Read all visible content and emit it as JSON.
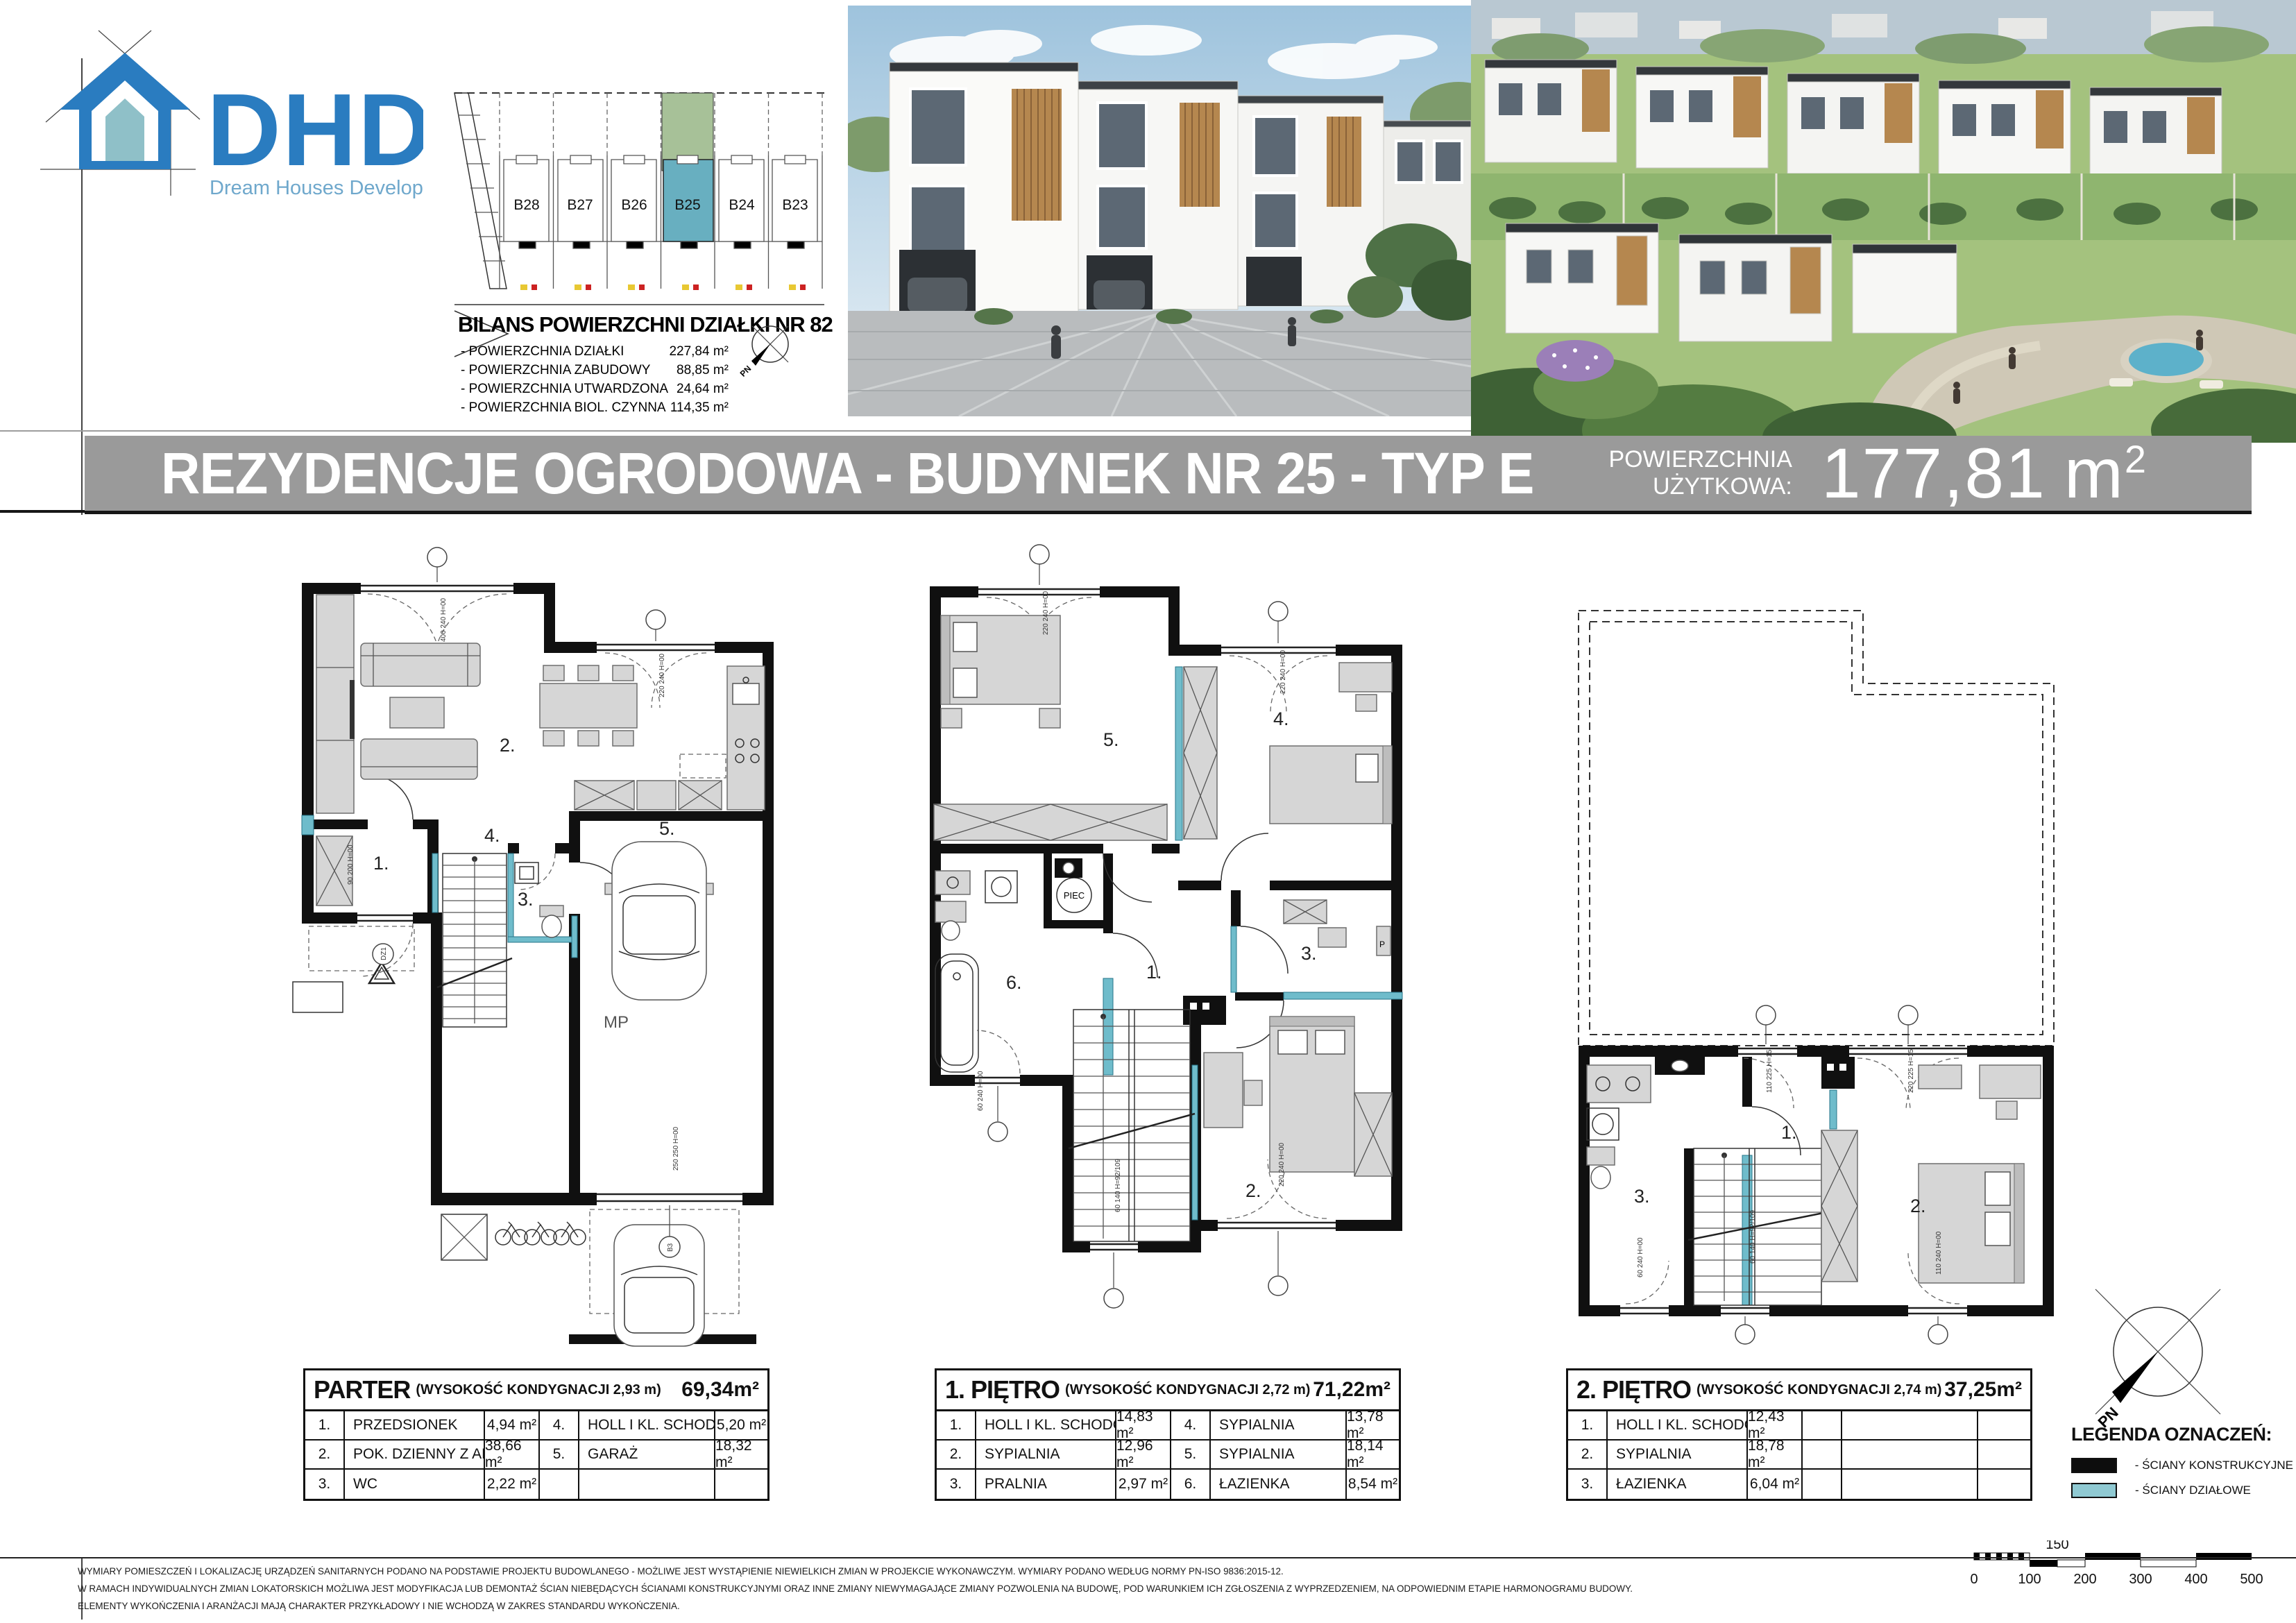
{
  "logo": {
    "abbr": "DHD",
    "tagline": "Dream Houses Development"
  },
  "site_plan": {
    "plots": [
      "B28",
      "B27",
      "B26",
      "B25",
      "B24",
      "B23"
    ],
    "highlighted_plot": "B25",
    "bilans_title": "BILANS POWIERZCHNI DZIAŁKI NR 823",
    "bilans_items": [
      {
        "label": "- POWIERZCHNIA DZIAŁKI",
        "value": "227,84 m²"
      },
      {
        "label": "- POWIERZCHNIA ZABUDOWY",
        "value": "88,85 m²"
      },
      {
        "label": "- POWIERZCHNIA UTWARDZONA",
        "value": "24,64 m²"
      },
      {
        "label": "- POWIERZCHNIA BIOL. CZYNNA",
        "value": "114,35 m²"
      }
    ],
    "compass_label": "PN"
  },
  "title_bar": {
    "title": "REZYDENCJE OGRODOWA - BUDYNEK NR 25 - TYP E",
    "area_label_line1": "POWIERZCHNIA",
    "area_label_line2": "UŻYTKOWA:",
    "area_value": "177,81",
    "area_unit": "m",
    "area_exponent": "2"
  },
  "plans": {
    "parter": {
      "rooms": [
        "1.",
        "2.",
        "3.",
        "4.",
        "5."
      ],
      "parking_label": "MP",
      "axis_labels": [
        "DZ1",
        "B3"
      ],
      "window_notes": [
        "400 240 H=00",
        "220 240 H=00",
        "90 200 H=00",
        "250 250 H=00"
      ]
    },
    "pietro1": {
      "rooms": [
        "1.",
        "2.",
        "3.",
        "4.",
        "5.",
        "6."
      ],
      "boiler_label": "PIEC",
      "p_label": "P",
      "window_notes": [
        "220 240 H=00",
        "220 240 H=00",
        "60 240 H=00",
        "60 140 H=92/109",
        "220 240 H=00"
      ]
    },
    "pietro2": {
      "rooms": [
        "1.",
        "2.",
        "3."
      ],
      "window_notes": [
        "110 225 H=15",
        "220 225 H=15",
        "60 240 H=00",
        "60 140 H=92/109",
        "110 240 H=00"
      ]
    }
  },
  "floors": [
    {
      "name": "PARTER",
      "height": "(WYSOKOŚĆ KONDYGNACJI 2,93 m)",
      "total": "69,34m²",
      "rows": [
        [
          {
            "no": "1.",
            "room": "PRZEDSIONEK",
            "area": "4,94 m²"
          },
          {
            "no": "4.",
            "room": "HOLL I KL. SCHODOWA",
            "area": "5,20 m²"
          }
        ],
        [
          {
            "no": "2.",
            "room": "POK. DZIENNY Z AN. KUCH.",
            "area": "38,66 m²"
          },
          {
            "no": "5.",
            "room": "GARAŻ",
            "area": "18,32 m²"
          }
        ],
        [
          {
            "no": "3.",
            "room": "WC",
            "area": "2,22 m²"
          },
          {
            "no": "",
            "room": "",
            "area": ""
          }
        ]
      ]
    },
    {
      "name": "1. PIĘTRO",
      "height": "(WYSOKOŚĆ KONDYGNACJI 2,72 m)",
      "total": "71,22m²",
      "rows": [
        [
          {
            "no": "1.",
            "room": "HOLL I KL. SCHODOWA",
            "area": "14,83 m²"
          },
          {
            "no": "4.",
            "room": "SYPIALNIA",
            "area": "13,78 m²"
          }
        ],
        [
          {
            "no": "2.",
            "room": "SYPIALNIA",
            "area": "12,96 m²"
          },
          {
            "no": "5.",
            "room": "SYPIALNIA",
            "area": "18,14 m²"
          }
        ],
        [
          {
            "no": "3.",
            "room": "PRALNIA",
            "area": "2,97 m²"
          },
          {
            "no": "6.",
            "room": "ŁAZIENKA",
            "area": "8,54 m²"
          }
        ]
      ]
    },
    {
      "name": "2. PIĘTRO",
      "height": "(WYSOKOŚĆ KONDYGNACJI 2,74 m)",
      "total": "37,25m²",
      "rows": [
        [
          {
            "no": "1.",
            "room": "HOLL I KL. SCHODOWA",
            "area": "12,43 m²"
          },
          {
            "no": "",
            "room": "",
            "area": ""
          }
        ],
        [
          {
            "no": "2.",
            "room": "SYPIALNIA",
            "area": "18,78 m²"
          },
          {
            "no": "",
            "room": "",
            "area": ""
          }
        ],
        [
          {
            "no": "3.",
            "room": "ŁAZIENKA",
            "area": "6,04 m²"
          },
          {
            "no": "",
            "room": "",
            "area": ""
          }
        ]
      ]
    }
  ],
  "legend": {
    "title": "LEGENDA OZNACZEŃ:",
    "items": [
      {
        "label": "- ŚCIANY KONSTRUKCYJNE"
      },
      {
        "label": "- ŚCIANY DZIAŁOWE"
      }
    ]
  },
  "compass": {
    "label": "PN"
  },
  "scale_bar": {
    "ticks": [
      "0",
      "100",
      "200",
      "300",
      "400",
      "500"
    ],
    "mid_label": "150"
  },
  "disclaimer": [
    "WYMIARY POMIESZCZEŃ I LOKALIZACJĘ URZĄDZEŃ SANITARNYCH PODANO NA PODSTAWIE PROJEKTU BUDOWLANEGO - MOŻLIWE JEST WYSTĄPIENIE NIEWIELKICH ZMIAN W PROJEKCIE WYKONAWCZYM. WYMIARY PODANO WEDŁUG NORMY PN-ISO 9836:2015-12.",
    "W RAMACH INDYWIDUALNYCH ZMIAN LOKATORSKICH MOŻLIWA JEST MODYFIKACJA LUB DEMONTAŻ ŚCIAN NIEBĘDĄCYCH ŚCIANAMI KONSTRUKCYJNYMI ORAZ INNE ZMIANY NIEWYMAGAJĄCE ZMIANY POZWOLENIA NA BUDOWĘ, POD WARUNKIEM ICH ZGŁOSZENIA Z WYPRZEDZENIEM, NA ODPOWIEDNIM ETAPIE HARMONOGRAMU BUDOWY.",
    "ELEMENTY WYKOŃCZENIA I ARANŻACJI MAJĄ CHARAKTER PRZYKŁADOWY I NIE WCHODZĄ W ZAKRES STANDARDU WYKOŃCZENIA."
  ],
  "colors": {
    "logo_blue": "#2a7cc0",
    "logo_teal": "#8fc0c8",
    "bar_gray": "#9a9a9a",
    "partition_teal": "#6fbccb",
    "legend_teal": "#8fc9d2",
    "plot_green": "#a7c198",
    "plot_blue": "#68afc0",
    "wood_accent": "#b5874f"
  }
}
